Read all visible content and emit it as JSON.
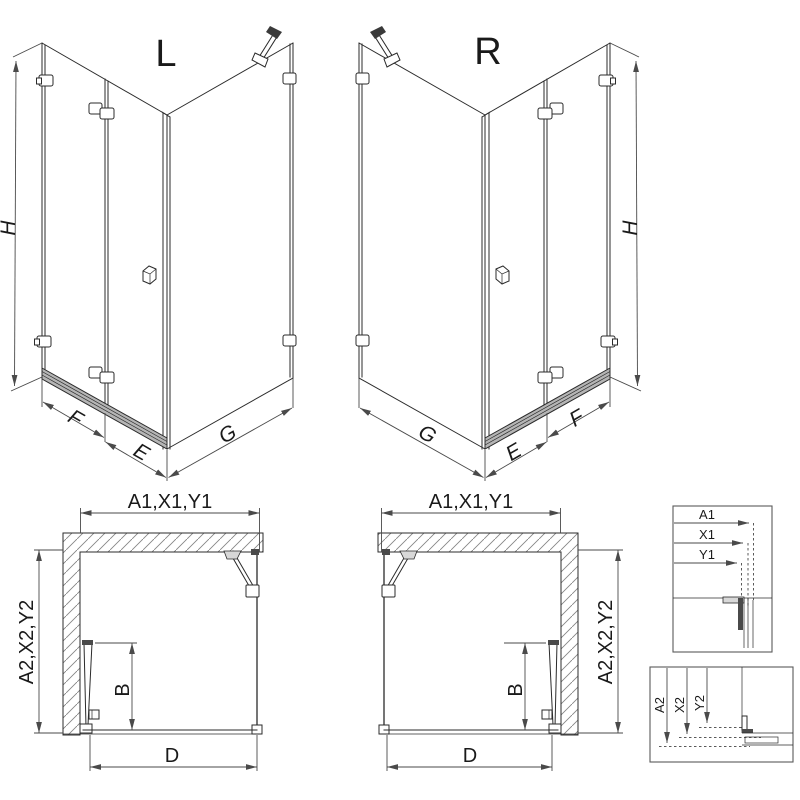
{
  "drawing": {
    "view_left": {
      "label": "L"
    },
    "view_right": {
      "label": "R"
    },
    "dims": {
      "height": "H",
      "fixed_door_width": "F",
      "door_width": "E",
      "side_panel_width": "G",
      "width_labels": "A1,X1,Y1",
      "depth_labels": "A2,X2,Y2",
      "folded_door": "B",
      "entry_width": "D"
    },
    "detail_width": {
      "labels": [
        "A1",
        "X1",
        "Y1"
      ]
    },
    "detail_depth": {
      "labels": [
        "A2",
        "X2",
        "Y2"
      ]
    }
  }
}
